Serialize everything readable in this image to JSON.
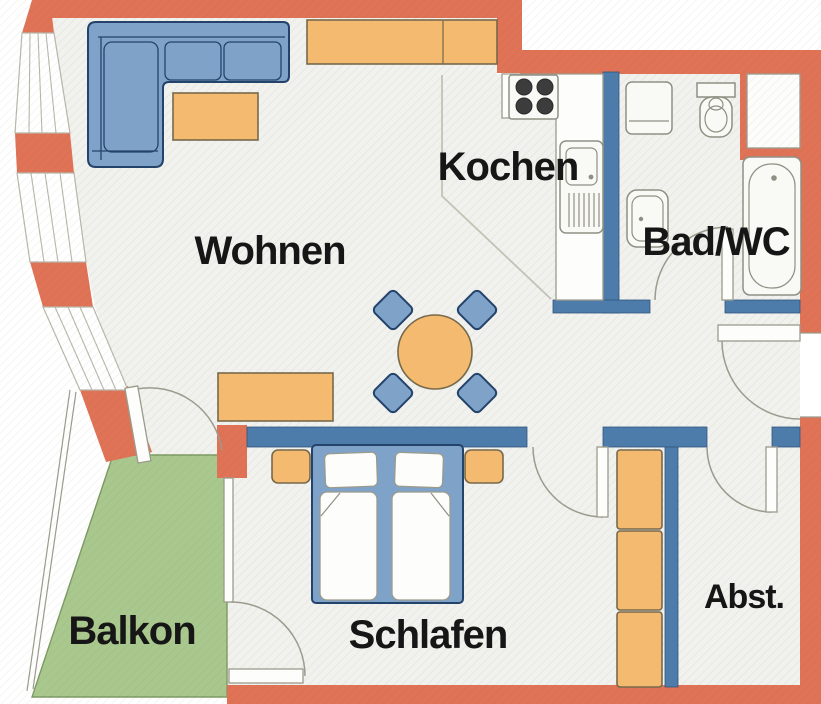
{
  "document": {
    "type": "apartment-floor-plan",
    "language": "de"
  },
  "rooms": {
    "living": {
      "label": "Wohnen"
    },
    "kitchen": {
      "label": "Kochen"
    },
    "bath": {
      "label": "Bad/WC"
    },
    "bedroom": {
      "label": "Schlafen"
    },
    "balcony": {
      "label": "Balkon"
    },
    "storage": {
      "label": "Abst."
    }
  },
  "colors": {
    "exterior_wall": "#e07256",
    "interior_wall": "#4d7cab",
    "furniture_wood": "#f3ba70",
    "furniture_upholstery": "#7fa2c9",
    "balcony_floor": "#a9c88e",
    "floor": "#f1f1ee",
    "label_text": "#161616"
  },
  "symbols": [
    "corner-sofa",
    "coffee-table",
    "tv-sideboard",
    "round-dining-table",
    "dining-chair",
    "sideboard",
    "double-bed",
    "nightstand",
    "wardrobe",
    "stove",
    "kitchen-sink",
    "kitchen-counter",
    "washing-machine",
    "toilet",
    "washbasin",
    "bathtub",
    "door-swing",
    "window-band",
    "balcony-railing"
  ]
}
